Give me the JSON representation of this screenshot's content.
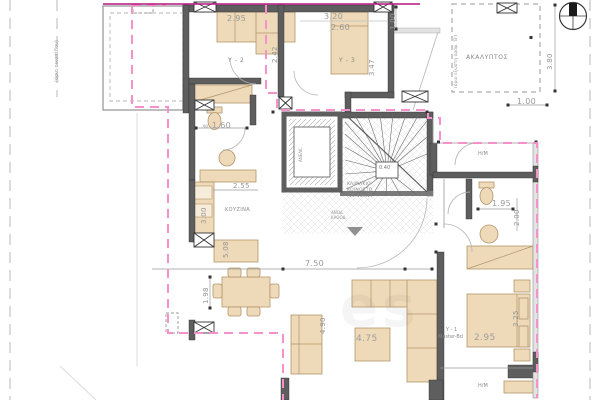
{
  "drawing": {
    "type": "architectural floor plan",
    "colors": {
      "wall": "#5e5e5e",
      "furniture": "#eed9b8",
      "balcony_dash": "#f791cc",
      "roof_line": "#b3177e"
    }
  },
  "labels": {
    "y2": "Υ - 2",
    "y3": "Υ - 3",
    "y1_line1": "Υ - 1",
    "y1_line2": "Master-Bd",
    "kitchen": "ΚΟΥΖΙΝΑ",
    "akalyptos": "ΑΚΑΛΥΠΤΟΣ",
    "hm_top": "Η/Μ",
    "hm_bottom": "Η/Μ",
    "stair_line1": "ΚΛΙΜΑΚΙΟ",
    "stair_line2": "ΚΟΙΝΟΣΤΟ",
    "stair_line3": "(15.48m2)",
    "elevator": "ΑΝΕΛΚ.",
    "entry_line1": "ΑΝΟΔ.",
    "entry_line2": "ΚΑΘΟΔ.",
    "boundary_note": "(όριο οικοπέδου)",
    "akalyptos_note": "(όριο εξώστη ορόφ. 'Β')",
    "bath_door_note": "90",
    "watermark": "es"
  },
  "dims": {
    "y2_w": "2.95",
    "y2_d": "2.42",
    "y3_w": "3.20",
    "y3_bed": "2.60",
    "y3_d": "3.47",
    "top_off": "1.00",
    "akal_d": "3.80",
    "akal_off": "1.00",
    "bath_w": "1.60",
    "kit_w": "2.55",
    "kit_d": "3.00",
    "kit_run": "5.08",
    "din_off": "1.98",
    "liv_w": "7.50",
    "liv_d": "4.90",
    "liv_t": "4.75",
    "mas_w": "2.95",
    "mas_d": "3.25",
    "bath2_w": "1.95",
    "bath2_d": "2.00",
    "stair_core": "0.40"
  }
}
